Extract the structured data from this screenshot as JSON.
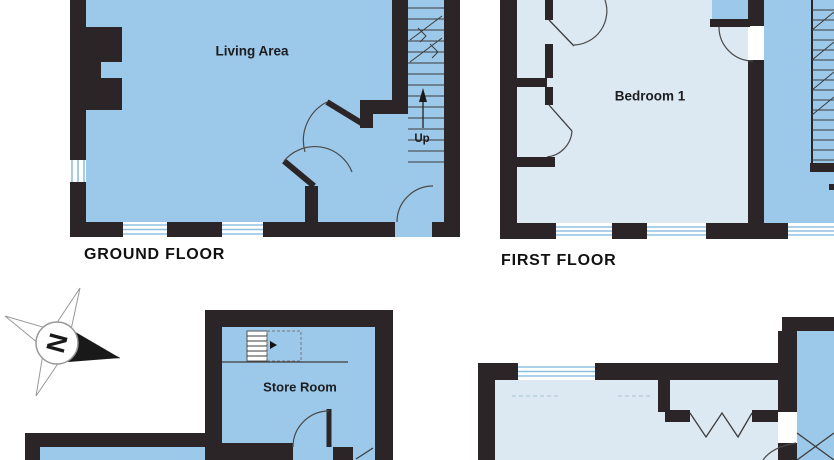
{
  "floor_plan": {
    "plans": {
      "ground_floor": {
        "title": "GROUND FLOOR",
        "room_label": "Living Area",
        "stairs_label": "Up"
      },
      "first_floor": {
        "title": "FIRST FLOOR",
        "room_label": "Bedroom 1"
      },
      "outbuilding": {
        "room_label": "Store Room"
      }
    },
    "compass": {
      "north_label": "N"
    },
    "colors": {
      "wall_color": "#2b2527",
      "room_fill": "#9cc9ea",
      "room_fill_light": "#dce8f2",
      "window_line": "#8fc0e0",
      "label_text": "#1d1d1f",
      "line_color": "#3c3c3c"
    }
  }
}
